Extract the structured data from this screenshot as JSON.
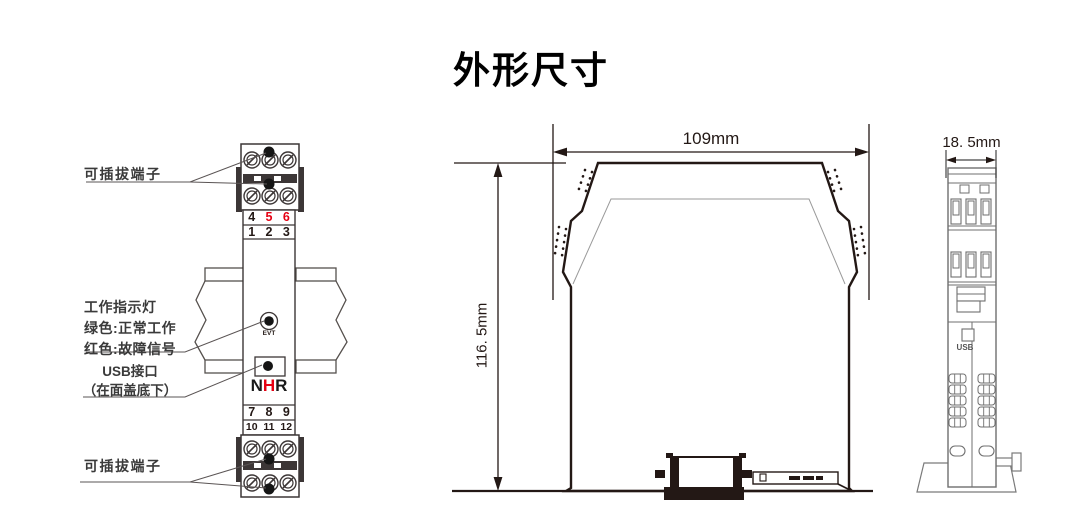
{
  "title": "外形尺寸",
  "left_view": {
    "pluggable_terminal_top": "可插拔端子",
    "pluggable_terminal_bottom": "可插拔端子",
    "indicator": {
      "line1": "工作指示灯",
      "line2": "绿色:正常工作",
      "line3": "红色:故障信号"
    },
    "usb": {
      "line1": "USB接口",
      "line2": "（在面盖底下）"
    },
    "led_label": "EVT",
    "logo": {
      "n": "N",
      "h": "H",
      "r": "R"
    },
    "terminals": {
      "row1": [
        "4",
        "5",
        "6"
      ],
      "row2": [
        "1",
        "2",
        "3"
      ],
      "row3": [
        "7",
        "8",
        "9"
      ],
      "row4": [
        "10",
        "11",
        "12"
      ]
    },
    "red_numbers": [
      "5",
      "6"
    ]
  },
  "middle_view": {
    "width_dim": "109mm",
    "height_dim": "116. 5mm"
  },
  "right_view": {
    "width_dim": "18. 5mm",
    "usb_label": "USB"
  },
  "colors": {
    "line_black": "#231815",
    "accent_red": "#e60012",
    "gray_line": "#6f6f6f"
  }
}
